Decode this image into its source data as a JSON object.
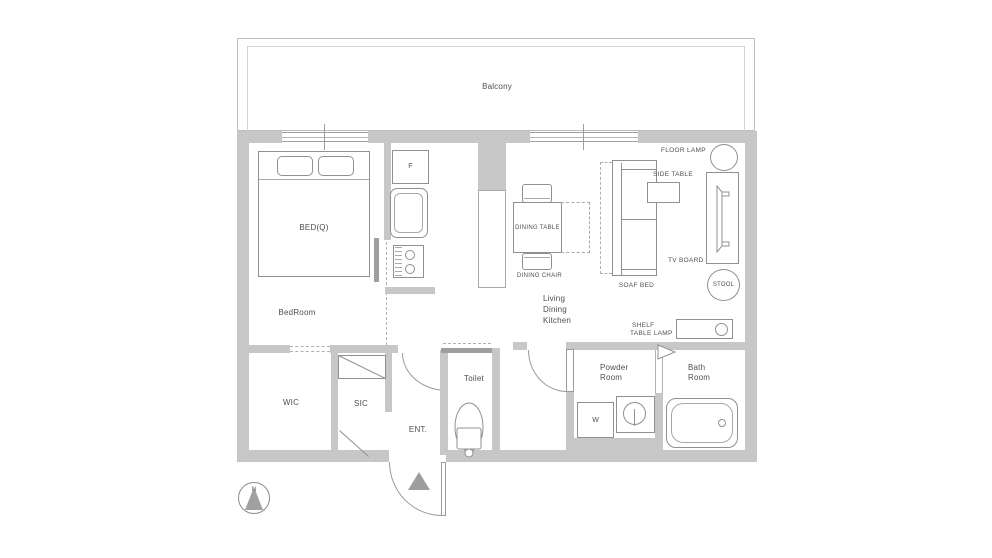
{
  "plan": {
    "balcony": "Balcony",
    "bedroom": {
      "name": "BedRoom",
      "bed": "BED(Q)"
    },
    "kitchen": {
      "fridge": "F"
    },
    "ldk": {
      "line1": "Living",
      "line2": "Dining",
      "line3": "Kitchen"
    },
    "dining": {
      "table": "DINING TABLE",
      "chair": "DINING CHAIR"
    },
    "living": {
      "sofa_bed": "SOAF BED",
      "side_table": "SIDE TABLE",
      "floor_lamp": "FLOOR LAMP",
      "tv_board": "TV BOARD",
      "stool": "STOOL",
      "shelf": "SHELF",
      "table_lamp": "TABLE LAMP"
    },
    "rooms": {
      "wic": "WIC",
      "sic": "SIC",
      "entrance": "ENT.",
      "toilet": "Toilet",
      "powder_line1": "Powder",
      "powder_line2": "Room",
      "bath_line1": "Bath",
      "bath_line2": "Room"
    },
    "powder": {
      "washer": "W"
    },
    "compass": {
      "north": "N"
    }
  },
  "colors": {
    "wall": "#c7c7c7",
    "line": "#909090",
    "jamb": "#9e9e9e",
    "text": "#4f4f4f"
  }
}
